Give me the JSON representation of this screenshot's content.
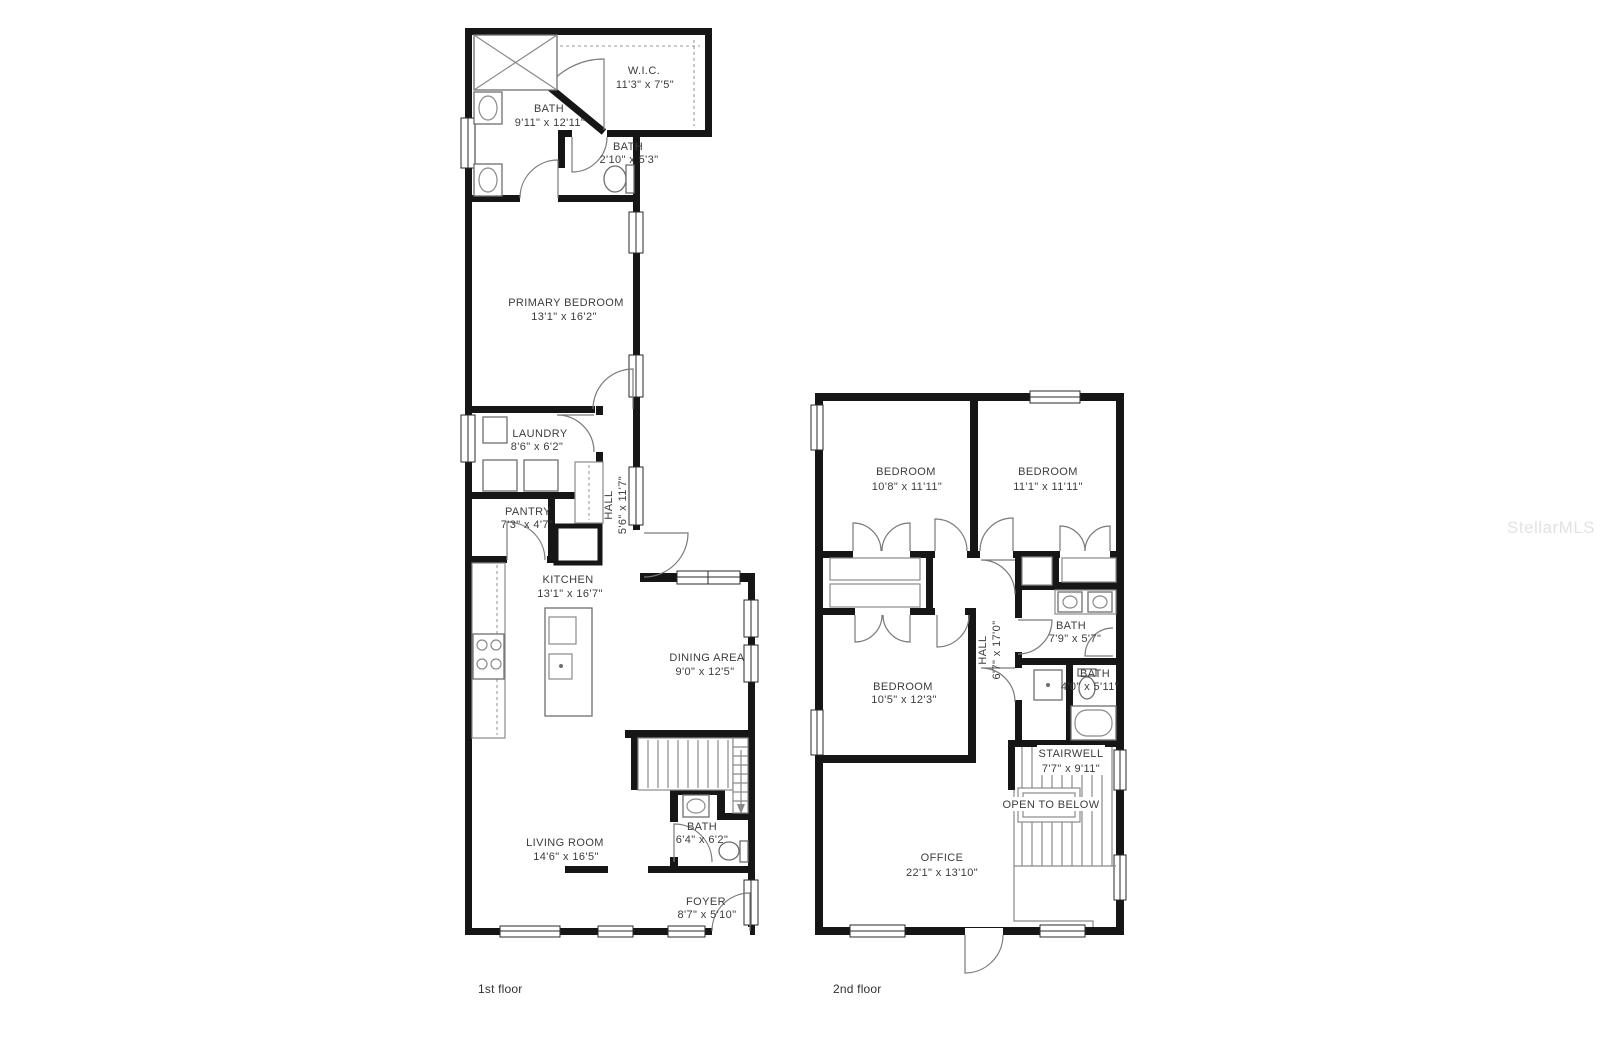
{
  "watermark": "StellarMLS",
  "floor1": {
    "caption": "1st floor",
    "rooms": {
      "bath_primary": {
        "name": "BATH",
        "dims": "9'11\" x 12'11\""
      },
      "wic": {
        "name": "W.I.C.",
        "dims": "11'3\" x 7'5\""
      },
      "bath_small": {
        "name": "BATH",
        "dims": "2'10\" x 5'3\""
      },
      "primary": {
        "name": "PRIMARY BEDROOM",
        "dims": "13'1\" x 16'2\""
      },
      "laundry": {
        "name": "LAUNDRY",
        "dims": "8'6\" x 6'2\""
      },
      "hall": {
        "name": "HALL",
        "dims": "5'6\" x 11'7\""
      },
      "pantry": {
        "name": "PANTRY",
        "dims": "7'3\" x 4'7\""
      },
      "kitchen": {
        "name": "KITCHEN",
        "dims": "13'1\" x 16'7\""
      },
      "dining": {
        "name": "DINING AREA",
        "dims": "9'0\" x 12'5\""
      },
      "living": {
        "name": "LIVING ROOM",
        "dims": "14'6\" x 16'5\""
      },
      "bath_half": {
        "name": "BATH",
        "dims": "6'4\" x 6'2\""
      },
      "foyer": {
        "name": "FOYER",
        "dims": "8'7\" x 5'10\""
      }
    }
  },
  "floor2": {
    "caption": "2nd floor",
    "open_below": "OPEN TO BELOW",
    "rooms": {
      "bedroom1": {
        "name": "BEDROOM",
        "dims": "10'8\" x 11'11\""
      },
      "bedroom2": {
        "name": "BEDROOM",
        "dims": "11'1\" x 11'11\""
      },
      "hall": {
        "name": "HALL",
        "dims": "6'7\" x 17'0\""
      },
      "bath1": {
        "name": "BATH",
        "dims": "7'9\" x 5'7\""
      },
      "bath2": {
        "name": "BATH",
        "dims": "4'0\" x 5'11\""
      },
      "bedroom3": {
        "name": "BEDROOM",
        "dims": "10'5\" x 12'3\""
      },
      "stairwell": {
        "name": "STAIRWELL",
        "dims": "7'7\" x 9'11\""
      },
      "office": {
        "name": "OFFICE",
        "dims": "22'1\" x 13'10\""
      }
    }
  }
}
